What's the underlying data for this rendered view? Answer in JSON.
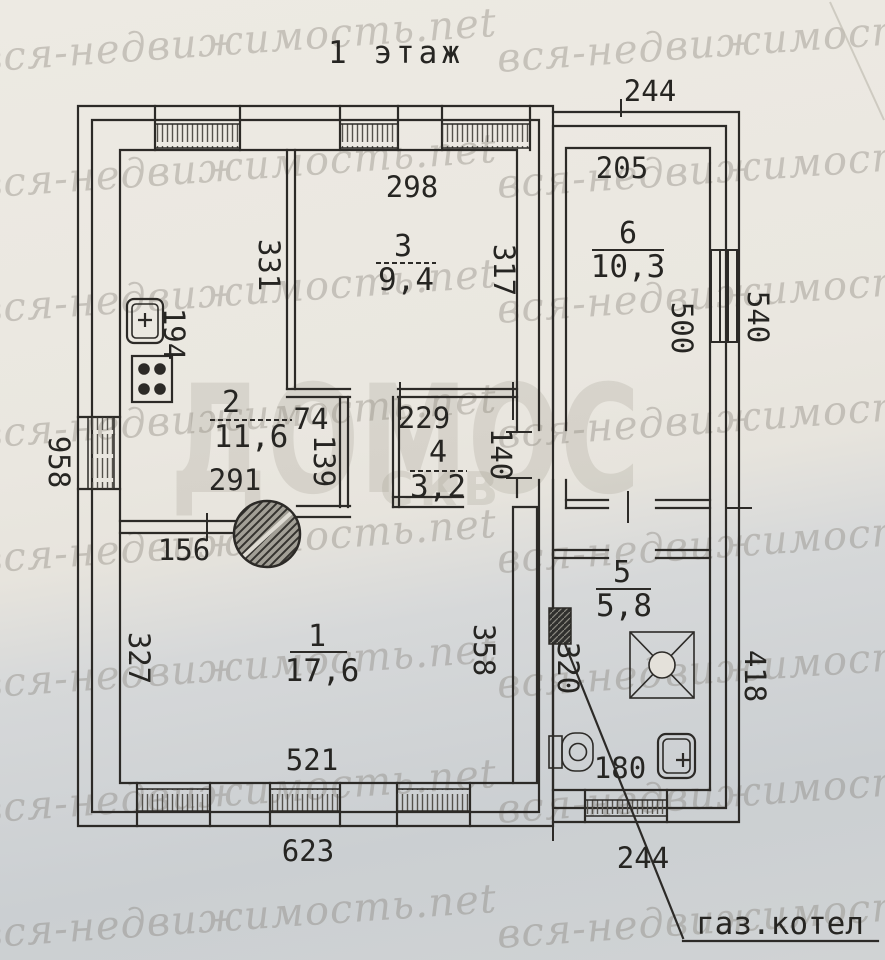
{
  "title": "1 этаж",
  "watermark": {
    "tiled": "вся-недвижимость.net",
    "big": "ДОМОС",
    "small": "СКВ"
  },
  "annotations": {
    "gas_boiler": "газ.котел"
  },
  "rooms": {
    "r1": {
      "num": "1",
      "area": "17,6"
    },
    "r2": {
      "num": "2",
      "area": "11,6"
    },
    "r3": {
      "num": "3",
      "area": "9,4"
    },
    "r4": {
      "num": "4",
      "area": "3,2"
    },
    "r5": {
      "num": "5",
      "area": "5,8"
    },
    "r6": {
      "num": "6",
      "area": "10,3"
    }
  },
  "dims": {
    "top244": "244",
    "d205": "205",
    "d298": "298",
    "d331": "331",
    "d317": "317",
    "d500": "500",
    "d540": "540",
    "d194": "194",
    "d74": "74",
    "d139": "139",
    "d291": "291",
    "d229": "229",
    "d140": "140",
    "d958": "958",
    "d156": "156",
    "d327": "327",
    "d358": "358",
    "d320": "320",
    "d521": "521",
    "d623": "623",
    "d180": "180",
    "bottom244": "244",
    "d418": "418"
  },
  "fixtures": [
    "kitchen-sink",
    "cooker",
    "round-stove",
    "gas-stove",
    "toilet",
    "washbasin",
    "gas-boiler"
  ],
  "colors": {
    "paper": "#eae7e0",
    "paper_shadow": "#ccd0d3",
    "ink": "#2c2a27",
    "watermark": "#8d887d"
  }
}
